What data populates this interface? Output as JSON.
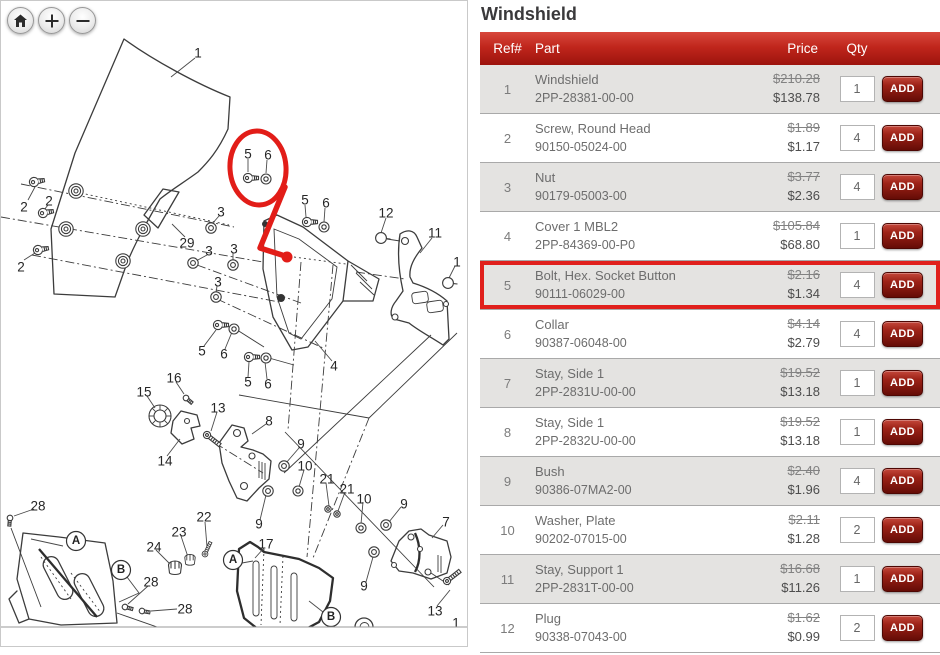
{
  "page_title": "Windshield",
  "diagram": {
    "zoom_controls": [
      {
        "name": "home",
        "icon": "home-icon"
      },
      {
        "name": "zoom-in",
        "icon": "plus-icon"
      },
      {
        "name": "zoom-out",
        "icon": "minus-icon"
      }
    ],
    "callouts": [
      {
        "label": "1",
        "x": 197,
        "y": 52
      },
      {
        "label": "2",
        "x": 23,
        "y": 206
      },
      {
        "label": "2",
        "x": 48,
        "y": 200
      },
      {
        "label": "2",
        "x": 20,
        "y": 266
      },
      {
        "label": "29",
        "x": 186,
        "y": 242
      },
      {
        "label": "3",
        "x": 220,
        "y": 211
      },
      {
        "label": "3",
        "x": 208,
        "y": 250
      },
      {
        "label": "3",
        "x": 233,
        "y": 248
      },
      {
        "label": "3",
        "x": 217,
        "y": 281
      },
      {
        "label": "5",
        "x": 247,
        "y": 153
      },
      {
        "label": "6",
        "x": 267,
        "y": 154
      },
      {
        "label": "5",
        "x": 304,
        "y": 199
      },
      {
        "label": "6",
        "x": 325,
        "y": 202
      },
      {
        "label": "12",
        "x": 385,
        "y": 212
      },
      {
        "label": "11",
        "x": 434,
        "y": 232
      },
      {
        "label": "1",
        "x": 456,
        "y": 261
      },
      {
        "label": "5",
        "x": 201,
        "y": 350
      },
      {
        "label": "6",
        "x": 223,
        "y": 353
      },
      {
        "label": "5",
        "x": 247,
        "y": 381
      },
      {
        "label": "6",
        "x": 267,
        "y": 383
      },
      {
        "label": "4",
        "x": 333,
        "y": 365
      },
      {
        "label": "16",
        "x": 173,
        "y": 377
      },
      {
        "label": "15",
        "x": 143,
        "y": 391
      },
      {
        "label": "13",
        "x": 217,
        "y": 407
      },
      {
        "label": "14",
        "x": 164,
        "y": 460
      },
      {
        "label": "8",
        "x": 268,
        "y": 420
      },
      {
        "label": "9",
        "x": 300,
        "y": 443
      },
      {
        "label": "10",
        "x": 304,
        "y": 465
      },
      {
        "label": "21",
        "x": 326,
        "y": 478
      },
      {
        "label": "21",
        "x": 346,
        "y": 488
      },
      {
        "label": "10",
        "x": 363,
        "y": 498
      },
      {
        "label": "9",
        "x": 403,
        "y": 503
      },
      {
        "label": "9",
        "x": 258,
        "y": 523
      },
      {
        "label": "7",
        "x": 445,
        "y": 521
      },
      {
        "label": "28",
        "x": 37,
        "y": 505
      },
      {
        "label": "22",
        "x": 203,
        "y": 516
      },
      {
        "label": "23",
        "x": 178,
        "y": 531
      },
      {
        "label": "24",
        "x": 153,
        "y": 546
      },
      {
        "label": "28",
        "x": 150,
        "y": 581
      },
      {
        "label": "28",
        "x": 184,
        "y": 608
      },
      {
        "label": "17",
        "x": 265,
        "y": 543
      },
      {
        "label": "9",
        "x": 363,
        "y": 585
      },
      {
        "label": "13",
        "x": 434,
        "y": 610
      },
      {
        "label": "1",
        "x": 455,
        "y": 622
      }
    ],
    "circled_letters": [
      {
        "label": "A",
        "x": 75,
        "y": 540
      },
      {
        "label": "B",
        "x": 120,
        "y": 569
      },
      {
        "label": "A",
        "x": 232,
        "y": 559
      },
      {
        "label": "B",
        "x": 330,
        "y": 616
      }
    ],
    "glyphs": [
      {
        "t": "bolt",
        "x": 33,
        "y": 181,
        "r": -10
      },
      {
        "t": "bolt",
        "x": 42,
        "y": 212,
        "r": -10
      },
      {
        "t": "bolt",
        "x": 37,
        "y": 249,
        "r": -10
      },
      {
        "t": "grommet",
        "x": 75,
        "y": 190
      },
      {
        "t": "grommet",
        "x": 65,
        "y": 228
      },
      {
        "t": "grommet",
        "x": 142,
        "y": 228
      },
      {
        "t": "grommet",
        "x": 122,
        "y": 260
      },
      {
        "t": "nut",
        "x": 210,
        "y": 227
      },
      {
        "t": "nut",
        "x": 192,
        "y": 262
      },
      {
        "t": "nut",
        "x": 232,
        "y": 264
      },
      {
        "t": "nut",
        "x": 215,
        "y": 296
      },
      {
        "t": "bolt",
        "x": 247,
        "y": 177
      },
      {
        "t": "washer",
        "x": 265,
        "y": 178
      },
      {
        "t": "bolt",
        "x": 306,
        "y": 221
      },
      {
        "t": "washer",
        "x": 323,
        "y": 226
      },
      {
        "t": "bolt",
        "x": 217,
        "y": 324
      },
      {
        "t": "washer",
        "x": 233,
        "y": 328
      },
      {
        "t": "bolt",
        "x": 248,
        "y": 356
      },
      {
        "t": "washer",
        "x": 265,
        "y": 357
      },
      {
        "t": "smallscrew",
        "x": 185,
        "y": 397,
        "r": 40
      },
      {
        "t": "longbolt",
        "x": 206,
        "y": 434,
        "r": 38
      },
      {
        "t": "longbolt",
        "x": 446,
        "y": 580,
        "r": -38
      },
      {
        "t": "nut",
        "x": 283,
        "y": 465
      },
      {
        "t": "nut",
        "x": 267,
        "y": 490
      },
      {
        "t": "nut",
        "x": 385,
        "y": 524
      },
      {
        "t": "nut",
        "x": 373,
        "y": 551
      },
      {
        "t": "washer",
        "x": 297,
        "y": 490
      },
      {
        "t": "washer",
        "x": 360,
        "y": 527
      },
      {
        "t": "ring",
        "x": 327,
        "y": 508
      },
      {
        "t": "ring",
        "x": 336,
        "y": 513
      },
      {
        "t": "smallscrew",
        "x": 9,
        "y": 517,
        "r": 95
      },
      {
        "t": "smallscrew",
        "x": 124,
        "y": 606,
        "r": 15
      },
      {
        "t": "smallscrew",
        "x": 141,
        "y": 610,
        "r": 10
      },
      {
        "t": "longbolt",
        "x": 204,
        "y": 553,
        "r": -65,
        "s": 0.8
      },
      {
        "t": "plug",
        "x": 380,
        "y": 237
      },
      {
        "t": "plug",
        "x": 447,
        "y": 282
      },
      {
        "t": "cup",
        "x": 174,
        "y": 567
      },
      {
        "t": "cup",
        "x": 189,
        "y": 559,
        "s": 0.8
      }
    ],
    "annotation": {
      "color": "#e21d18",
      "ellipse": {
        "cx": 257,
        "cy": 167,
        "rx": 28,
        "ry": 37,
        "rotate": -4
      },
      "arrow_points": "284,186 259,247 281,254",
      "dot": {
        "x": 286,
        "y": 256,
        "r": 5.5
      }
    }
  },
  "table": {
    "columns": {
      "ref": "Ref#",
      "part": "Part",
      "price": "Price",
      "qty": "Qty"
    },
    "add_label": "ADD",
    "highlight_color": "#e0201c",
    "rows": [
      {
        "ref": "1",
        "name": "Windshield",
        "number": "2PP-28381-00-00",
        "old_price": "$210.28",
        "price": "$138.78",
        "qty": "1",
        "highlighted": false
      },
      {
        "ref": "2",
        "name": "Screw, Round Head",
        "number": "90150-05024-00",
        "old_price": "$1.89",
        "price": "$1.17",
        "qty": "4",
        "highlighted": false
      },
      {
        "ref": "3",
        "name": "Nut",
        "number": "90179-05003-00",
        "old_price": "$3.77",
        "price": "$2.36",
        "qty": "4",
        "highlighted": false
      },
      {
        "ref": "4",
        "name": "Cover 1 MBL2",
        "number": "2PP-84369-00-P0",
        "old_price": "$105.84",
        "price": "$68.80",
        "qty": "1",
        "highlighted": false
      },
      {
        "ref": "5",
        "name": "Bolt, Hex. Socket Button",
        "number": "90111-06029-00",
        "old_price": "$2.16",
        "price": "$1.34",
        "qty": "4",
        "highlighted": true
      },
      {
        "ref": "6",
        "name": "Collar",
        "number": "90387-06048-00",
        "old_price": "$4.14",
        "price": "$2.79",
        "qty": "4",
        "highlighted": false
      },
      {
        "ref": "7",
        "name": "Stay, Side 1",
        "number": "2PP-2831U-00-00",
        "old_price": "$19.52",
        "price": "$13.18",
        "qty": "1",
        "highlighted": false
      },
      {
        "ref": "8",
        "name": "Stay, Side 1",
        "number": "2PP-2832U-00-00",
        "old_price": "$19.52",
        "price": "$13.18",
        "qty": "1",
        "highlighted": false
      },
      {
        "ref": "9",
        "name": "Bush",
        "number": "90386-07MA2-00",
        "old_price": "$2.40",
        "price": "$1.96",
        "qty": "4",
        "highlighted": false
      },
      {
        "ref": "10",
        "name": "Washer, Plate",
        "number": "90202-07015-00",
        "old_price": "$2.11",
        "price": "$1.28",
        "qty": "2",
        "highlighted": false
      },
      {
        "ref": "11",
        "name": "Stay, Support 1",
        "number": "2PP-2831T-00-00",
        "old_price": "$16.68",
        "price": "$11.26",
        "qty": "1",
        "highlighted": false
      },
      {
        "ref": "12",
        "name": "Plug",
        "number": "90338-07043-00",
        "old_price": "$1.62",
        "price": "$0.99",
        "qty": "2",
        "highlighted": false
      }
    ]
  }
}
